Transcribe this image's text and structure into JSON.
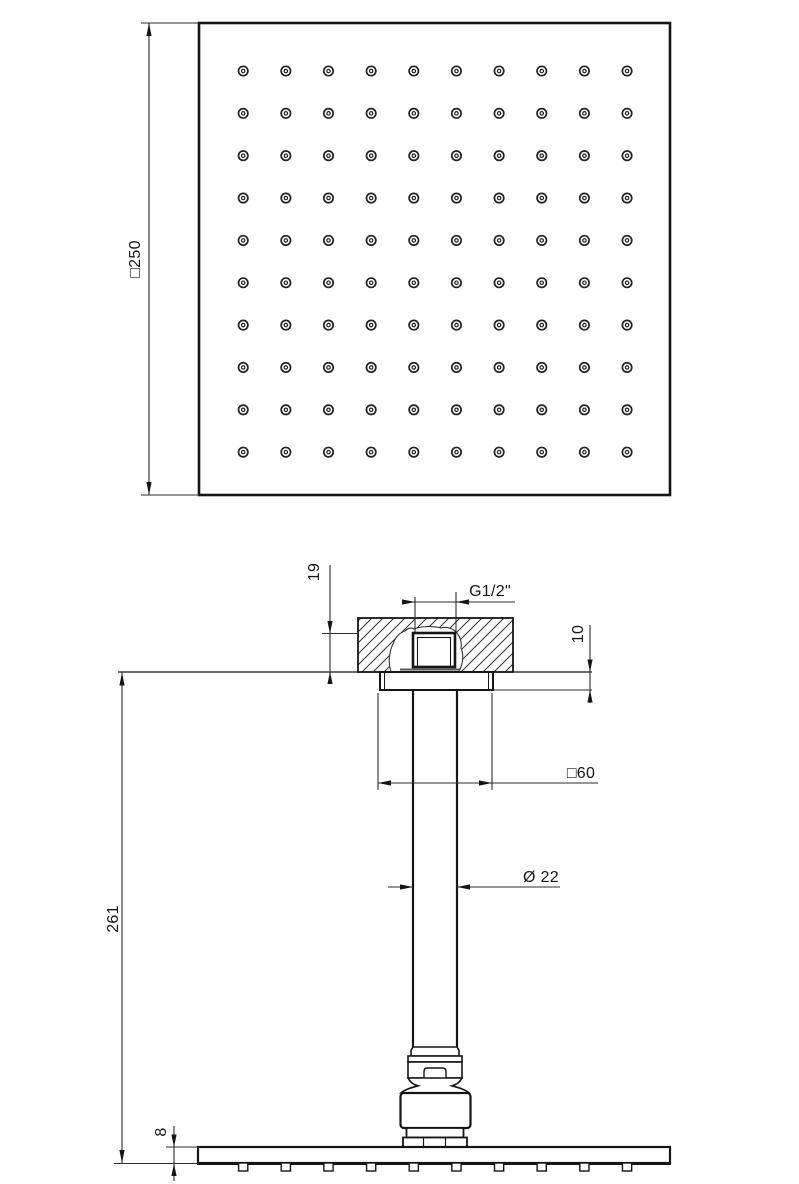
{
  "drawing": {
    "background_color": "#ffffff",
    "line_color": "#151515",
    "dimension_line_color": "#2c2c2c",
    "top_view": {
      "description": "square shower head face with nozzle grid",
      "size_dimension": "□250",
      "holes_rows": 10,
      "holes_cols": 10
    },
    "section_view": {
      "description": "ceiling-mounted shower arm section",
      "dim_embed_depth": "19",
      "dim_thread": "G1/2\"",
      "dim_escutcheon_thickness": "10",
      "dim_escutcheon_size": "□60",
      "dim_arm_diameter": "Ø 22",
      "dim_ceiling_to_face": "261",
      "dim_plate_thickness": "8",
      "nozzle_count": 10
    }
  }
}
